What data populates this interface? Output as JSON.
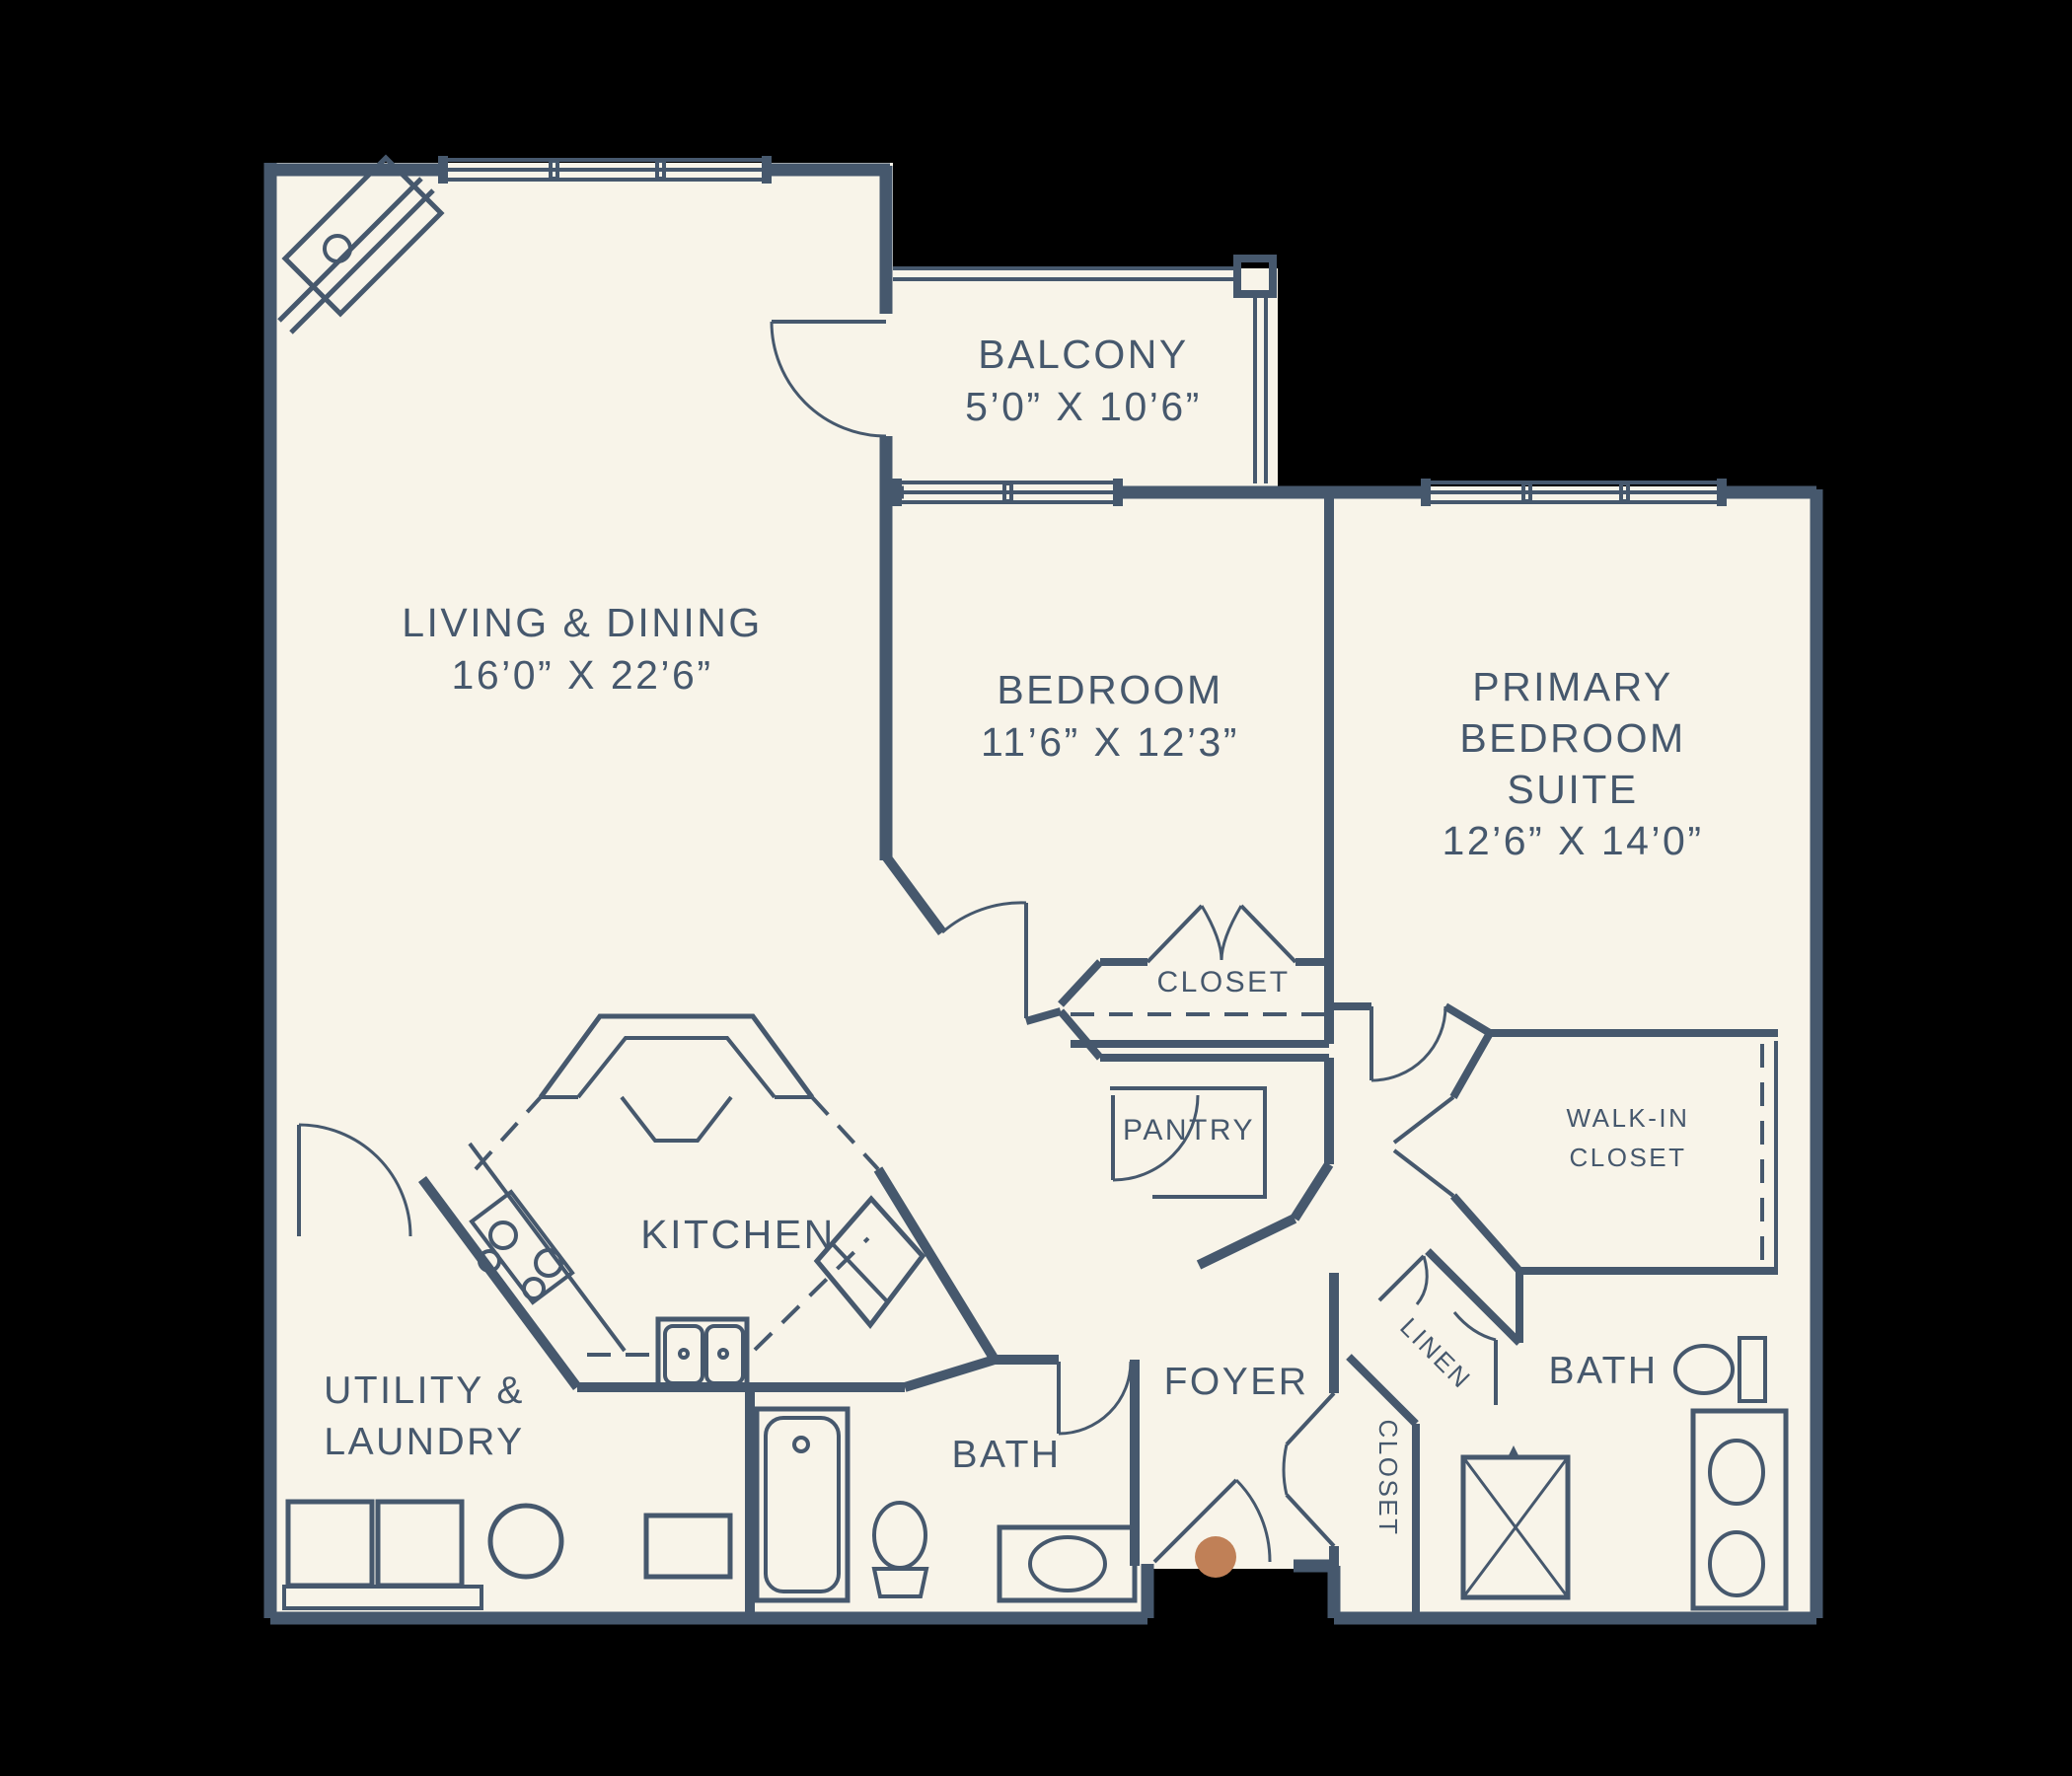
{
  "page": {
    "title": "Apartment Floor Plan"
  },
  "colors": {
    "background": "#000000",
    "plan_fill": "#f8f4e9",
    "line": "#46586d",
    "entry_dot": "#c08057"
  },
  "rooms": {
    "living": {
      "name": "LIVING & DINING",
      "dims": "16’0” X 22’6”"
    },
    "balcony": {
      "name": "BALCONY",
      "dims": "5’0” X 10’6”"
    },
    "bedroom": {
      "name": "BEDROOM",
      "dims": "11’6” X 12’3”"
    },
    "primary": {
      "line1": "PRIMARY",
      "line2": "BEDROOM",
      "line3": "SUITE",
      "dims": "12’6” X 14’0”"
    },
    "kitchen": {
      "name": "KITCHEN"
    },
    "utility": {
      "line1": "UTILITY &",
      "line2": "LAUNDRY"
    },
    "bath_left": {
      "name": "BATH"
    },
    "bath_right": {
      "name": "BATH"
    },
    "foyer": {
      "name": "FOYER"
    },
    "bedroom_closet": {
      "name": "CLOSET"
    },
    "pantry": {
      "name": "PANTRY"
    },
    "walk_in_closet": {
      "line1": "WALK-IN",
      "line2": "CLOSET"
    },
    "linen": {
      "name": "LINEN"
    },
    "foyer_closet": {
      "name": "CLOSET"
    }
  }
}
